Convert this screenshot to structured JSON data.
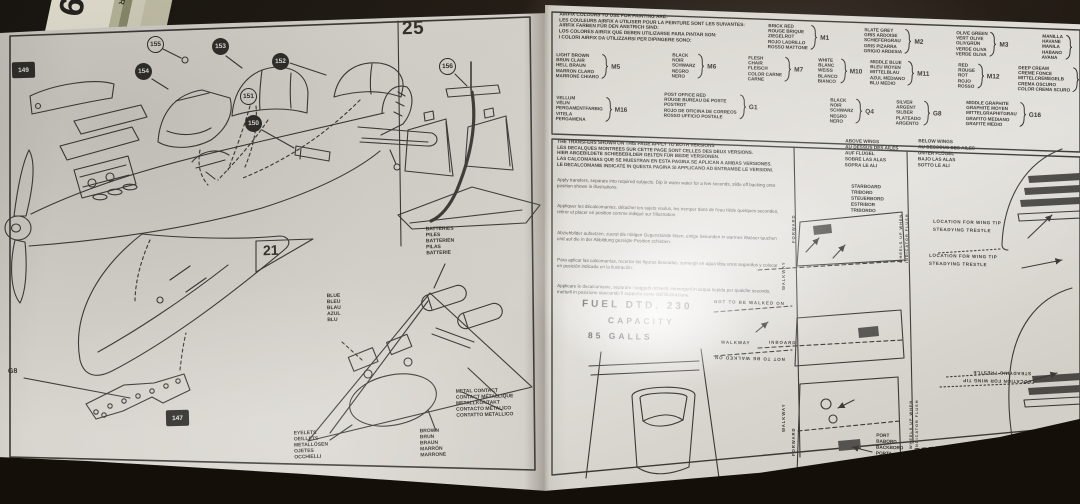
{
  "card": {
    "big": "09",
    "side": "AR"
  },
  "left": {
    "step_25": "25",
    "step_21": "21",
    "callout_147": "147",
    "callout_149": "149",
    "callout_150": "150",
    "callout_151": "151",
    "callout_152": "152",
    "callout_153": "153",
    "callout_154": "154",
    "callout_155": "155",
    "callout_156": "156",
    "g8": "G8",
    "batteries": "BATTERIES\nPILES\nBATTERIEN\nPILAS\nBATTERIE",
    "blue": "BLUE\nBLEU\nBLAU\nAZUL\nBLU",
    "metal_contact": "METAL CONTACT\nCONTACT MÉTALLIQUE\nMETALLKONTAKT\nCONTACTO METALICO\nCONTATTO METALLICO",
    "brown": "BROWN\nBRUN\nBRAUN\nMARRÓN\nMARRONE",
    "eyelets": "EYELETS\nOEILLETS\nMETALLÖSEN\nOJETES\nOCCHIELLI"
  },
  "paint": {
    "header": "AIRFIX COLOURS TO USE FOR PAINTING ARE:\nLES COULEURS AIRFIX A UTILISER POUR LA PEINTURE SONT LES SUIVANTES:\nAIRFIX FARBEN FÜR DEN ANSTRICH SIND:\nLOS COLORES AIRFIX QUE DEBEN UTILIZARSE PARA PINTAR SON:\nI COLORI AIRFIX DA UTILIZZARSI PER DIPINGERE SONO:",
    "cells": [
      {
        "names": "BRICK RED\nROUGE BRIQUE\nZIEGELROT\nROJO LADRILLO\nROSSO MATTONE",
        "code": "M1"
      },
      {
        "names": "SLATE GREY\nGRIS ARDOISE\nSCHIEFERGRAU\nGRIS PIZARRA\nGRIGIO ARDESIA",
        "code": "M2"
      },
      {
        "names": "OLIVE GREEN\nVERT OLIVE\nOLIVGRÜN\nVERDE OLIVA\nVERDE OLIVA",
        "code": "M3"
      },
      {
        "names": "MANILLA\nHAVANE\nMANILA\nHABANO\nAVANA",
        "code": ""
      },
      {
        "names": "LIGHT BROWN\nBRUN CLAIR\nHELL BRAUN\nMARRON CLARO\nMARRONE CHIARO",
        "code": "M5"
      },
      {
        "names": "BLACK\nNOIR\nSCHWARZ\nNEGRO\nNERO",
        "code": "M6"
      },
      {
        "names": "FLESH\nCHAIR\nFLEISCH\nCOLOR CARNE\nCARNE",
        "code": "M7"
      },
      {
        "names": "WHITE\nBLANC\nWEISS\nBLANCO\nBIANCO",
        "code": "M10"
      },
      {
        "names": "MIDDLE BLUE\nBLEU MOYEN\nMITTELBLAU\nAZUL MEDIANO\nBLU MEDIO",
        "code": "M11"
      },
      {
        "names": "RED\nROUGE\nROT\nROJO\nROSSO",
        "code": "M12"
      },
      {
        "names": "DEEP CREAM\nCREME FONCE\nMITTELCREMEGELB\nCREMA OSCURO\nCOLOR CREMA SCURO",
        "code": ""
      },
      {
        "names": "VELLUM\nVÉLIN\nPERGAMENTFARBIG\nVITELA\nPERGAMENA",
        "code": "M16"
      },
      {
        "names": "POST OFFICE RED\nROUGE BUREAU DE POSTE\nPOSTROT\nROJO DE OFICINA DE CORREOS\nROSSO UFFICIO POSTALE",
        "code": "G1"
      },
      {
        "names": "BLACK\nNOIR\nSCHWARZ\nNEGRO\nNERO",
        "code": "Q4"
      },
      {
        "names": "SILVER\nARGENT\nSILBER\nPLATEADO\nARGENTO",
        "code": "G8"
      },
      {
        "names": "MIDDLE GRAPHITE\nGRAPHITE MOYEN\nMITTELGRAPHITGRAU\nGRAFITO MEDIANO\nGRAFITE MEDIO",
        "code": "G16"
      }
    ]
  },
  "transfers": {
    "header": "THE TRANSFERS SHOWN ON THIS PAGE APPLY TO BOTH VERSIONS\nLES DECALQUES MONTREES SUR CETTE PAGE SONT CELLES DES DEUX VERSIONS.\nHIER ABGEBILDETE SCHIEBEBILDER GELTEN FÜR BEIDE VERSIONEN.\nLAS CALCOMANIAS QUE SE MUESTRAN EN ESTA PAGINA SE APLICAN A AMBAS VERSIONES.\nLE DECALCOMANIE INDICATE IN QUESTA PAGINA SI APPLICANO AD ENTRAMBE LE VERSIONI.",
    "paras": [
      "Apply transfers, separate into required subjects. Dip in warm water for a few seconds, slide off backing onto position shown in illustrations.",
      "Appliquer les décalcomanies, détacher les sujets voulus, les tremper dans de l'eau tiède quelques secondes, retirer et placer en position comme indiqué sur l'illustration.",
      "Abziehbilder aufsetzen, zuerst die nötigen Gegenstände lösen, einige Sekunden in warmes Wasser tauchen und auf die in der Abbildung gezeigte Position schieben.",
      "Para aplicar las calcomanías, recortar las figuras deseadas, sumergir en agua tibia unos segundos y colocar en posición indicada en la ilustración.",
      "Applicare le decalcomanie, separare i soggetti richiesti, immergerli in acqua tiepida per qualche secondo, metterli in posizione staccando il supporto come dall'illustrazione."
    ],
    "fuel_line1": "FUEL  DTD. 230",
    "fuel_line2": "CAPACITY",
    "fuel_line3": "85  GALLS",
    "above_wings": "ABOVE WINGS\nAU DESSUS DES AILES\nAUF FLÜGEL\nSOBRE LAS ALAS\nSOPRA LE ALI",
    "below_wings": "BELOW WINGS\nAU DESSOUS DES AILES\nUNTER FLÜGEL\nBAJO LAS ALAS\nSOTTO LE ALI",
    "starboard": "STARBOARD\nTRIBORD\nSTEUERBORD\nESTRIBOR\nTRIBORDO",
    "port": "PORT\nBABORD\nBACKBORD\nPORTA\nPORTELLO",
    "not_walk": "NOT TO BE WALKED ON",
    "walkway": "WALKWAY",
    "inboard": "INBOARD",
    "forward": "FORWARD",
    "wheels": "WHEELS UP WHEN\nINDICATOR FLUSH",
    "trestle": "LOCATION FOR WING TIP\nSTEADYING TRESTLE"
  }
}
